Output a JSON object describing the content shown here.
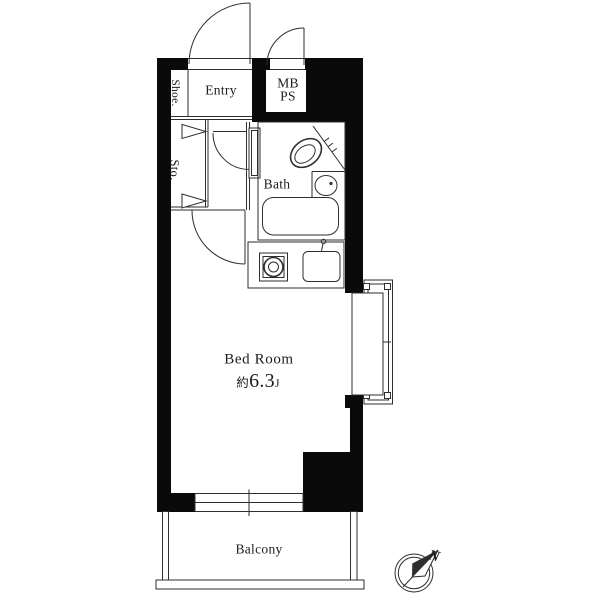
{
  "labels": {
    "shoe": "Shoe.",
    "entry": "Entry",
    "meter_box": "MB",
    "pipe_space": "PS",
    "storage": "Sto.",
    "bath": "Bath",
    "bedroom": "Bed Room",
    "bedroom_area_prefix": "約",
    "bedroom_area_value": "6.3",
    "bedroom_area_unit": "J",
    "balcony": "Balcony",
    "north": "N"
  },
  "colors": {
    "wall": "#0a0a0a",
    "line": "#2e2e2e",
    "text": "#1c1c1c",
    "background": "#ffffff"
  }
}
